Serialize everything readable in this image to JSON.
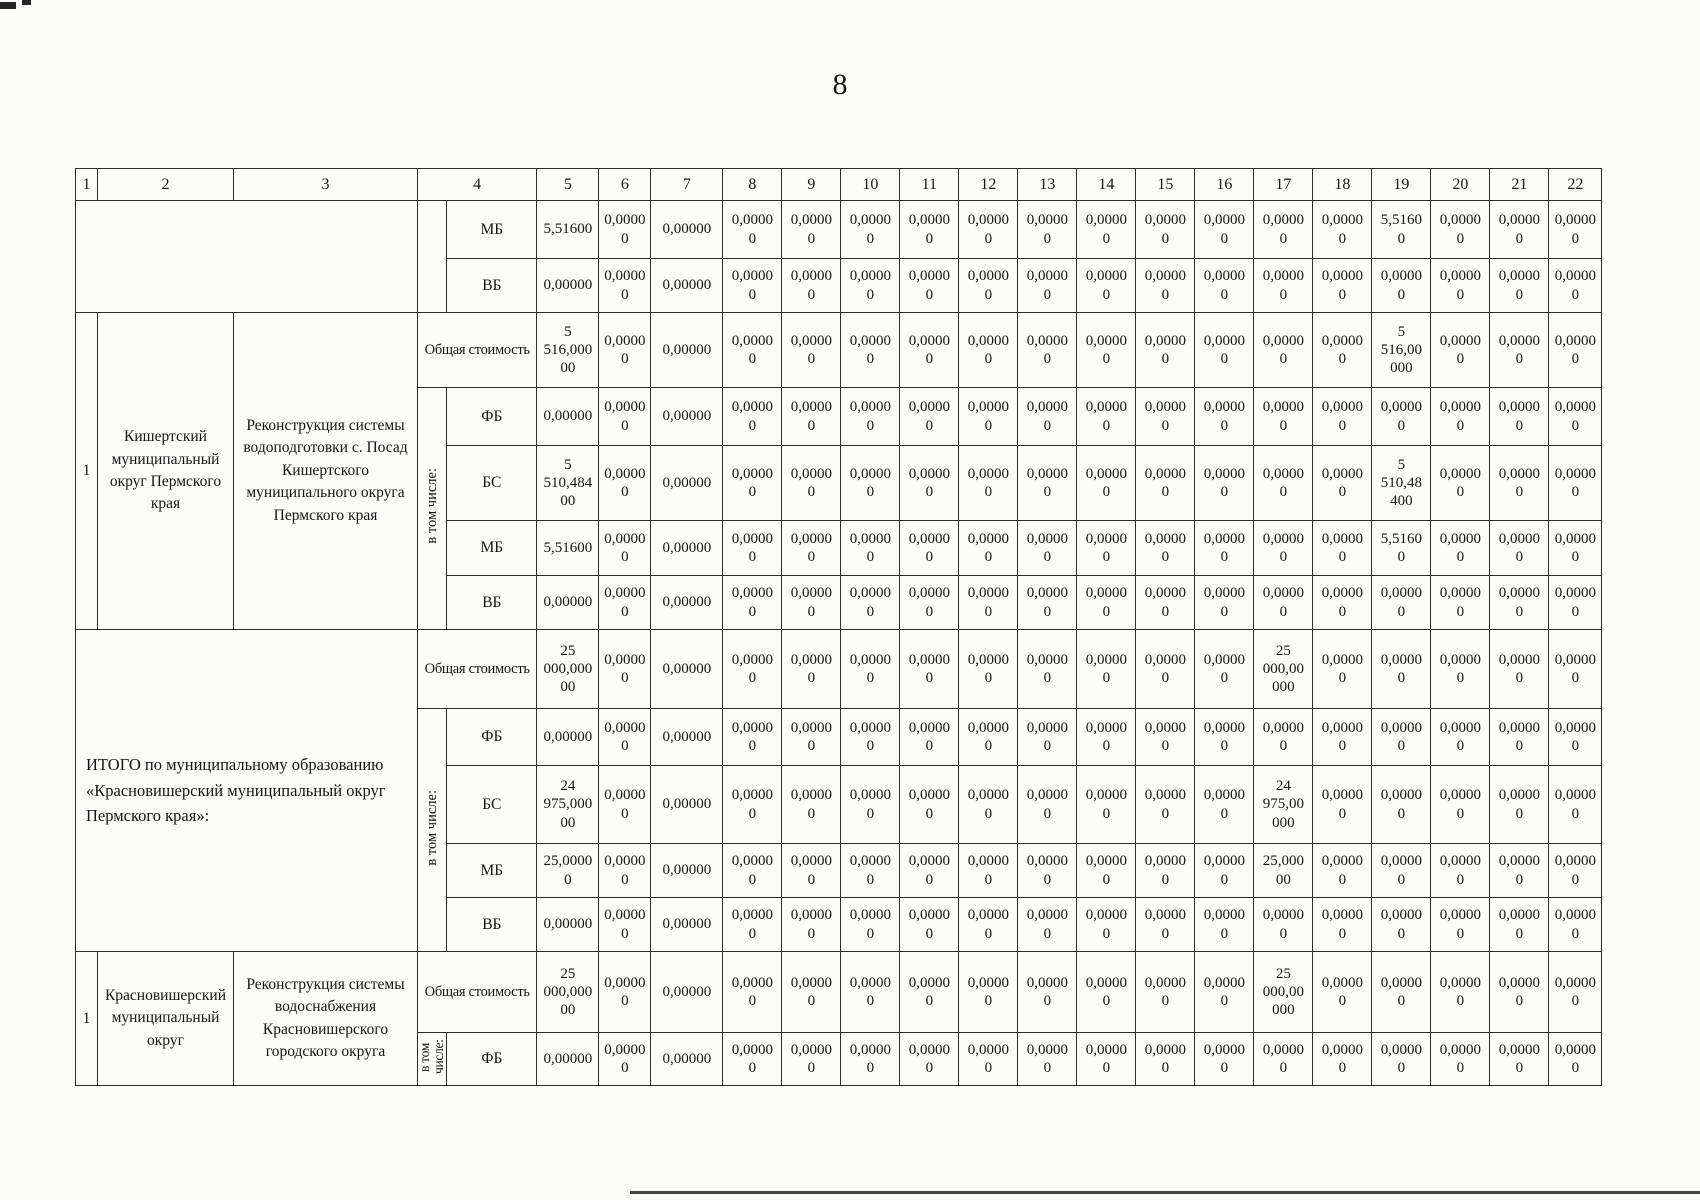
{
  "page": {
    "number": "8"
  },
  "table": {
    "column_headers": [
      "1",
      "2",
      "3",
      "4",
      "5",
      "6",
      "7",
      "8",
      "9",
      "10",
      "11",
      "12",
      "13",
      "14",
      "15",
      "16",
      "17",
      "18",
      "19",
      "20",
      "21",
      "22"
    ],
    "row_labels": {
      "total_cost": "Общая стоимость",
      "including": "в том числе:",
      "fb": "ФБ",
      "bs": "БС",
      "mb": "МБ",
      "vb": "ВБ"
    },
    "blocks": [
      {
        "type": "carryover",
        "rows": [
          {
            "label": "МБ",
            "values": [
              "5,51600",
              "0,0000\n0",
              "0,00000",
              "0,0000\n0",
              "0,0000\n0",
              "0,0000\n0",
              "0,0000\n0",
              "0,0000\n0",
              "0,0000\n0",
              "0,0000\n0",
              "0,0000\n0",
              "0,0000\n0",
              "0,0000\n0",
              "0,0000\n0",
              "5,5160\n0",
              "0,0000\n0",
              "0,0000\n0",
              "0,0000\n0"
            ]
          },
          {
            "label": "ВБ",
            "values": [
              "0,00000",
              "0,0000\n0",
              "0,00000",
              "0,0000\n0",
              "0,0000\n0",
              "0,0000\n0",
              "0,0000\n0",
              "0,0000\n0",
              "0,0000\n0",
              "0,0000\n0",
              "0,0000\n0",
              "0,0000\n0",
              "0,0000\n0",
              "0,0000\n0",
              "0,0000\n0",
              "0,0000\n0",
              "0,0000\n0",
              "0,0000\n0"
            ]
          }
        ]
      },
      {
        "type": "entry",
        "num": "1",
        "territory": "Кишертский муниципальный округ Пермского края",
        "project": "Реконструкция системы водоподготовки с. Посад Кишертского муниципального округа Пермского края",
        "including": "в том числе:",
        "rows": [
          {
            "label": "Общая стоимость",
            "values": [
              "5\n516,000\n00",
              "0,0000\n0",
              "0,00000",
              "0,0000\n0",
              "0,0000\n0",
              "0,0000\n0",
              "0,0000\n0",
              "0,0000\n0",
              "0,0000\n0",
              "0,0000\n0",
              "0,0000\n0",
              "0,0000\n0",
              "0,0000\n0",
              "0,0000\n0",
              "5\n516,00\n000",
              "0,0000\n0",
              "0,0000\n0",
              "0,0000\n0"
            ]
          },
          {
            "label": "ФБ",
            "values": [
              "0,00000",
              "0,0000\n0",
              "0,00000",
              "0,0000\n0",
              "0,0000\n0",
              "0,0000\n0",
              "0,0000\n0",
              "0,0000\n0",
              "0,0000\n0",
              "0,0000\n0",
              "0,0000\n0",
              "0,0000\n0",
              "0,0000\n0",
              "0,0000\n0",
              "0,0000\n0",
              "0,0000\n0",
              "0,0000\n0",
              "0,0000\n0"
            ]
          },
          {
            "label": "БС",
            "values": [
              "5\n510,484\n00",
              "0,0000\n0",
              "0,00000",
              "0,0000\n0",
              "0,0000\n0",
              "0,0000\n0",
              "0,0000\n0",
              "0,0000\n0",
              "0,0000\n0",
              "0,0000\n0",
              "0,0000\n0",
              "0,0000\n0",
              "0,0000\n0",
              "0,0000\n0",
              "5\n510,48\n400",
              "0,0000\n0",
              "0,0000\n0",
              "0,0000\n0"
            ]
          },
          {
            "label": "МБ",
            "values": [
              "5,51600",
              "0,0000\n0",
              "0,00000",
              "0,0000\n0",
              "0,0000\n0",
              "0,0000\n0",
              "0,0000\n0",
              "0,0000\n0",
              "0,0000\n0",
              "0,0000\n0",
              "0,0000\n0",
              "0,0000\n0",
              "0,0000\n0",
              "0,0000\n0",
              "5,5160\n0",
              "0,0000\n0",
              "0,0000\n0",
              "0,0000\n0"
            ]
          },
          {
            "label": "ВБ",
            "values": [
              "0,00000",
              "0,0000\n0",
              "0,00000",
              "0,0000\n0",
              "0,0000\n0",
              "0,0000\n0",
              "0,0000\n0",
              "0,0000\n0",
              "0,0000\n0",
              "0,0000\n0",
              "0,0000\n0",
              "0,0000\n0",
              "0,0000\n0",
              "0,0000\n0",
              "0,0000\n0",
              "0,0000\n0",
              "0,0000\n0",
              "0,0000\n0"
            ]
          }
        ]
      },
      {
        "type": "summary",
        "summary": "ИТОГО по муниципальному образованию «Красновишерский муниципальный округ Пермского края»:",
        "including": "в том числе:",
        "rows": [
          {
            "label": "Общая стоимость",
            "values": [
              "25\n000,000\n00",
              "0,0000\n0",
              "0,00000",
              "0,0000\n0",
              "0,0000\n0",
              "0,0000\n0",
              "0,0000\n0",
              "0,0000\n0",
              "0,0000\n0",
              "0,0000\n0",
              "0,0000\n0",
              "0,0000\n0",
              "25\n000,00\n000",
              "0,0000\n0",
              "0,0000\n0",
              "0,0000\n0",
              "0,0000\n0",
              "0,0000\n0"
            ]
          },
          {
            "label": "ФБ",
            "values": [
              "0,00000",
              "0,0000\n0",
              "0,00000",
              "0,0000\n0",
              "0,0000\n0",
              "0,0000\n0",
              "0,0000\n0",
              "0,0000\n0",
              "0,0000\n0",
              "0,0000\n0",
              "0,0000\n0",
              "0,0000\n0",
              "0,0000\n0",
              "0,0000\n0",
              "0,0000\n0",
              "0,0000\n0",
              "0,0000\n0",
              "0,0000\n0"
            ]
          },
          {
            "label": "БС",
            "values": [
              "24\n975,000\n00",
              "0,0000\n0",
              "0,00000",
              "0,0000\n0",
              "0,0000\n0",
              "0,0000\n0",
              "0,0000\n0",
              "0,0000\n0",
              "0,0000\n0",
              "0,0000\n0",
              "0,0000\n0",
              "0,0000\n0",
              "24\n975,00\n000",
              "0,0000\n0",
              "0,0000\n0",
              "0,0000\n0",
              "0,0000\n0",
              "0,0000\n0"
            ]
          },
          {
            "label": "МБ",
            "values": [
              "25,0000\n0",
              "0,0000\n0",
              "0,00000",
              "0,0000\n0",
              "0,0000\n0",
              "0,0000\n0",
              "0,0000\n0",
              "0,0000\n0",
              "0,0000\n0",
              "0,0000\n0",
              "0,0000\n0",
              "0,0000\n0",
              "25,000\n00",
              "0,0000\n0",
              "0,0000\n0",
              "0,0000\n0",
              "0,0000\n0",
              "0,0000\n0"
            ]
          },
          {
            "label": "ВБ",
            "values": [
              "0,00000",
              "0,0000\n0",
              "0,00000",
              "0,0000\n0",
              "0,0000\n0",
              "0,0000\n0",
              "0,0000\n0",
              "0,0000\n0",
              "0,0000\n0",
              "0,0000\n0",
              "0,0000\n0",
              "0,0000\n0",
              "0,0000\n0",
              "0,0000\n0",
              "0,0000\n0",
              "0,0000\n0",
              "0,0000\n0",
              "0,0000\n0"
            ]
          }
        ]
      },
      {
        "type": "entry",
        "num": "1",
        "territory": "Красновишерский муниципальный округ",
        "project": "Реконструкция системы водоснабжения Красновишерского городского округа",
        "including": "в том числе:",
        "rows": [
          {
            "label": "Общая стоимость",
            "values": [
              "25\n000,000\n00",
              "0,0000\n0",
              "0,00000",
              "0,0000\n0",
              "0,0000\n0",
              "0,0000\n0",
              "0,0000\n0",
              "0,0000\n0",
              "0,0000\n0",
              "0,0000\n0",
              "0,0000\n0",
              "0,0000\n0",
              "25\n000,00\n000",
              "0,0000\n0",
              "0,0000\n0",
              "0,0000\n0",
              "0,0000\n0",
              "0,0000\n0"
            ]
          },
          {
            "label": "ФБ",
            "values": [
              "0,00000",
              "0,0000\n0",
              "0,00000",
              "0,0000\n0",
              "0,0000\n0",
              "0,0000\n0",
              "0,0000\n0",
              "0,0000\n0",
              "0,0000\n0",
              "0,0000\n0",
              "0,0000\n0",
              "0,0000\n0",
              "0,0000\n0",
              "0,0000\n0",
              "0,0000\n0",
              "0,0000\n0",
              "0,0000\n0",
              "0,0000\n0"
            ]
          }
        ]
      }
    ]
  }
}
